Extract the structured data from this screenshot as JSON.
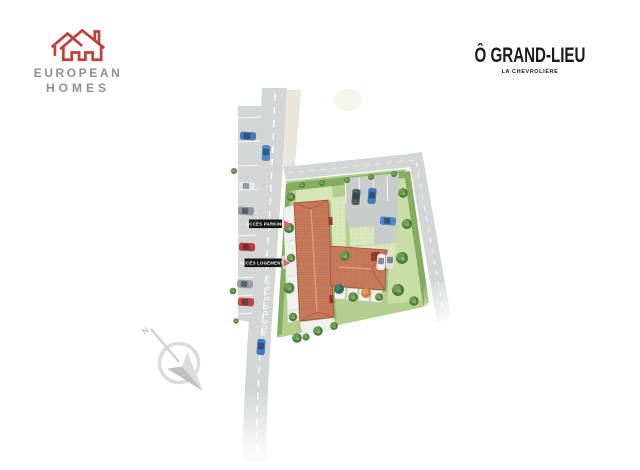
{
  "header": {
    "brand": {
      "name_line1": "EUROPEAN",
      "name_line2": "HOMES"
    },
    "project": {
      "title": "Ô GRAND-LIEU",
      "location": "LA CHEVROLIÈRE"
    }
  },
  "plan": {
    "street_label": "RUE DU STADE",
    "access_parking_label": "ACCÈS PARKING",
    "access_housing_label": "ACCÈS LOGEMENTS",
    "compass_north_label": "N"
  },
  "colors": {
    "brand_red": "#c2403a",
    "brand_gray": "#8e9092",
    "title_black": "#1b1b1b",
    "accent_pink": "#e85f80",
    "label_bg": "#151515",
    "road_gray": "#d3d6d4",
    "sidewalk_beige": "#eae6dc",
    "lawn_green": "#b4cf8d",
    "lawn_light": "#cbdfa9",
    "hedge_green": "#84ad60",
    "tree_green": "#4e7c3c",
    "roof_terracotta": "#c87a5b",
    "roof_dark": "#9c523a",
    "parking_gray": "#c8ccca",
    "terrace_white": "#f0f1ec",
    "car_blue": "#4179bd",
    "car_red": "#c03a3a",
    "car_gray": "#9aa0a5",
    "compass_gray": "#cccccc"
  }
}
